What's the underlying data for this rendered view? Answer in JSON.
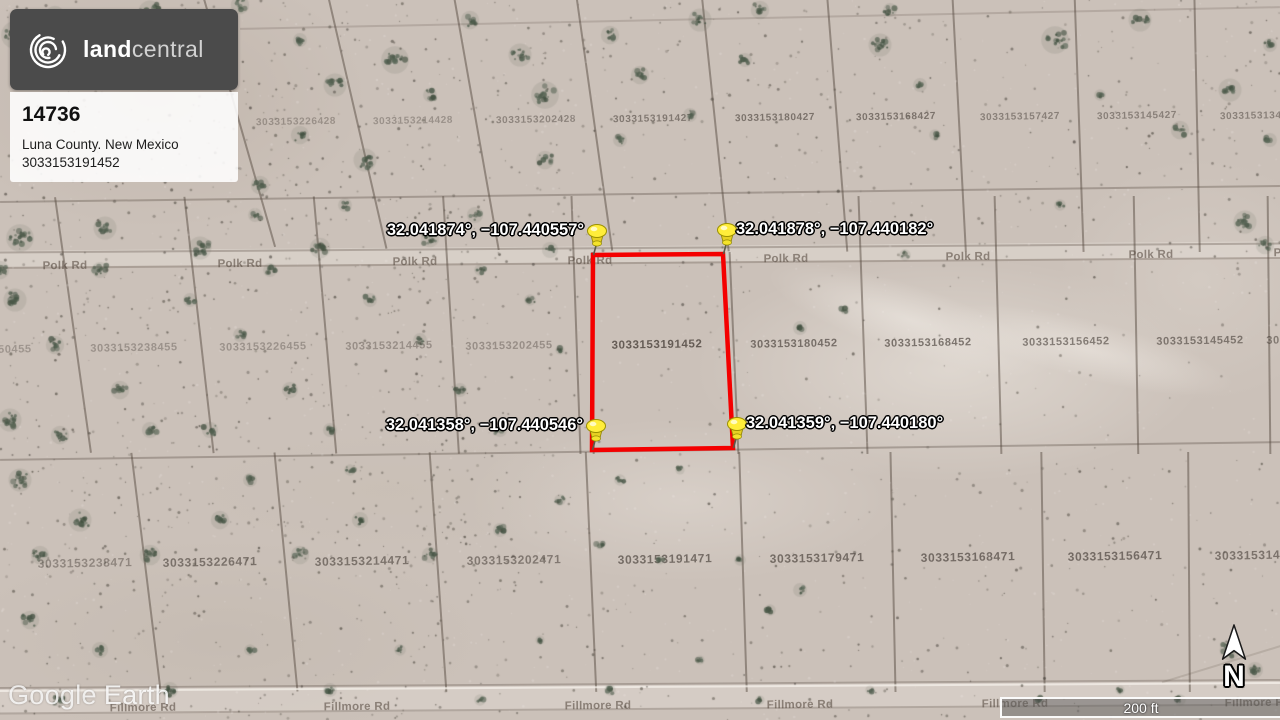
{
  "listing_card": {
    "brand_bold": "land",
    "brand_light": "central",
    "listing_id": "14736",
    "location": "Luna County. New Mexico",
    "parcel_id": "3033153191452"
  },
  "watermark": {
    "text_primary": "Google",
    "text_secondary": "Earth"
  },
  "scale_bar": {
    "label": "200 ft"
  },
  "compass": {
    "label": "N"
  },
  "parcel_outline": {
    "color": "#f40000",
    "points": [
      [
        593,
        255
      ],
      [
        723,
        254
      ],
      [
        733,
        448
      ],
      [
        592,
        450
      ]
    ]
  },
  "pins": [
    {
      "x": 593,
      "y": 255,
      "label": "32.041874°, −107.440557°",
      "side": "left"
    },
    {
      "x": 723,
      "y": 254,
      "label": "32.041878°, −107.440182°",
      "side": "right"
    },
    {
      "x": 592,
      "y": 450,
      "label": "32.041358°, −107.440546°",
      "side": "left"
    },
    {
      "x": 733,
      "y": 448,
      "label": "32.041359°, −107.440180°",
      "side": "right"
    }
  ],
  "parcel_numbers": [
    {
      "text": "3033153226428",
      "x": 296,
      "y": 122,
      "fs": 10,
      "opacity": 0.33
    },
    {
      "text": "3033153214428",
      "x": 413,
      "y": 121,
      "fs": 10,
      "opacity": 0.33
    },
    {
      "text": "3033153202428",
      "x": 536,
      "y": 120,
      "fs": 10,
      "opacity": 0.42
    },
    {
      "text": "3033153191427",
      "x": 653,
      "y": 119,
      "fs": 10,
      "opacity": 0.5
    },
    {
      "text": "3033153180427",
      "x": 775,
      "y": 118,
      "fs": 10,
      "opacity": 0.55
    },
    {
      "text": "3033153168427",
      "x": 896,
      "y": 117,
      "fs": 10,
      "opacity": 0.55
    },
    {
      "text": "3033153157427",
      "x": 1020,
      "y": 117,
      "fs": 10,
      "opacity": 0.45
    },
    {
      "text": "3033153145427",
      "x": 1137,
      "y": 116,
      "fs": 10,
      "opacity": 0.45
    },
    {
      "text": "3033153134427",
      "x": 1260,
      "y": 116,
      "fs": 10,
      "opacity": 0.45
    },
    {
      "text": "3033153250455",
      "x": -12,
      "y": 350,
      "fs": 11,
      "opacity": 0.3
    },
    {
      "text": "3033153238455",
      "x": 134,
      "y": 348,
      "fs": 11,
      "opacity": 0.32
    },
    {
      "text": "3033153226455",
      "x": 263,
      "y": 347,
      "fs": 11,
      "opacity": 0.32
    },
    {
      "text": "3033153214455",
      "x": 389,
      "y": 346,
      "fs": 11,
      "opacity": 0.35
    },
    {
      "text": "3033153202455",
      "x": 509,
      "y": 346,
      "fs": 11,
      "opacity": 0.35
    },
    {
      "text": "3033153191452",
      "x": 657,
      "y": 345,
      "fs": 11.5,
      "opacity": 0.7
    },
    {
      "text": "3033153180452",
      "x": 794,
      "y": 344,
      "fs": 11,
      "opacity": 0.6
    },
    {
      "text": "3033153168452",
      "x": 928,
      "y": 343,
      "fs": 11,
      "opacity": 0.6
    },
    {
      "text": "3033153156452",
      "x": 1066,
      "y": 342,
      "fs": 11,
      "opacity": 0.55
    },
    {
      "text": "3033153145452",
      "x": 1200,
      "y": 341,
      "fs": 11,
      "opacity": 0.55
    },
    {
      "text": "3033153134452",
      "x": 1310,
      "y": 340,
      "fs": 11,
      "opacity": 0.5
    },
    {
      "text": "3033153238471",
      "x": 85,
      "y": 563,
      "fs": 12,
      "opacity": 0.4
    },
    {
      "text": "3033153226471",
      "x": 210,
      "y": 562,
      "fs": 12,
      "opacity": 0.55
    },
    {
      "text": "3033153214471",
      "x": 362,
      "y": 561,
      "fs": 12,
      "opacity": 0.55
    },
    {
      "text": "3033153202471",
      "x": 514,
      "y": 560,
      "fs": 12,
      "opacity": 0.5
    },
    {
      "text": "3033153191471",
      "x": 665,
      "y": 559,
      "fs": 12,
      "opacity": 0.6
    },
    {
      "text": "3033153179471",
      "x": 817,
      "y": 558,
      "fs": 12,
      "opacity": 0.6
    },
    {
      "text": "3033153168471",
      "x": 968,
      "y": 557,
      "fs": 12,
      "opacity": 0.6
    },
    {
      "text": "3033153156471",
      "x": 1115,
      "y": 556,
      "fs": 12,
      "opacity": 0.6
    },
    {
      "text": "3033153145471",
      "x": 1262,
      "y": 555,
      "fs": 12,
      "opacity": 0.55
    }
  ],
  "road_labels": [
    {
      "text": "Polk Rd",
      "x": 65,
      "y": 266
    },
    {
      "text": "Polk Rd",
      "x": 240,
      "y": 264
    },
    {
      "text": "Polk Rd",
      "x": 415,
      "y": 262
    },
    {
      "text": "Polk Rd",
      "x": 590,
      "y": 261
    },
    {
      "text": "Polk Rd",
      "x": 786,
      "y": 259
    },
    {
      "text": "Polk Rd",
      "x": 968,
      "y": 257
    },
    {
      "text": "Polk Rd",
      "x": 1151,
      "y": 255
    },
    {
      "text": "Polk Rd",
      "x": 1296,
      "y": 253
    },
    {
      "text": "Fillmore Rd",
      "x": 143,
      "y": 708
    },
    {
      "text": "Fillmore Rd",
      "x": 357,
      "y": 707
    },
    {
      "text": "Fillmore Rd",
      "x": 598,
      "y": 706
    },
    {
      "text": "Fillmore Rd",
      "x": 800,
      "y": 705
    },
    {
      "text": "Fillmore Rd",
      "x": 1015,
      "y": 704
    },
    {
      "text": "Fillmore Rd",
      "x": 1258,
      "y": 703
    }
  ],
  "colors": {
    "outline_red": "#f40000",
    "pin_yellow": "#ffed3a",
    "ground_sand": "#cbc1b9",
    "vegetation_green": "#4f5b4f",
    "card_dark": "#4b4b4b"
  }
}
